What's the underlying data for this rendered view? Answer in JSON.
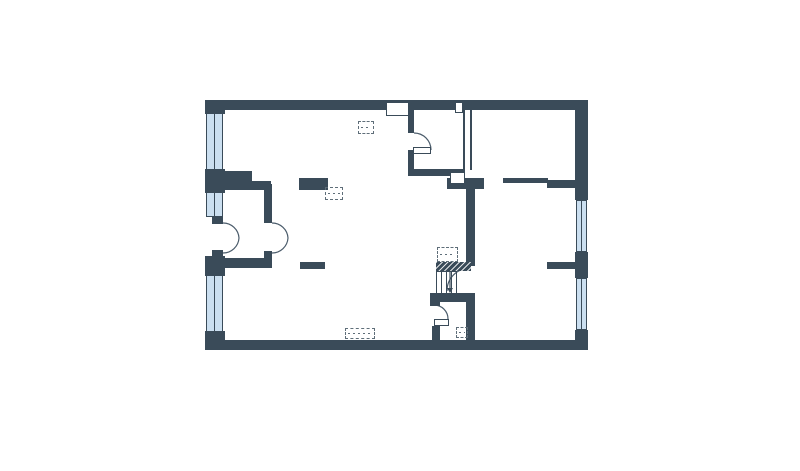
{
  "colors": {
    "wall": "#3a4b59",
    "window_fill": "#cbdff0",
    "symbol": "#5f6e79",
    "arc": "#4a5b6a",
    "background": "#ffffff"
  },
  "plan": {
    "canvas": {
      "width": 800,
      "height": 471
    },
    "walls": [
      {
        "name": "top-wall",
        "x": 205,
        "y": 100,
        "w": 383,
        "h": 10
      },
      {
        "name": "bottom-wall",
        "x": 205,
        "y": 340,
        "w": 383,
        "h": 10
      },
      {
        "name": "left-wall-top",
        "x": 205,
        "y": 100,
        "w": 20,
        "h": 14
      },
      {
        "name": "left-wall-mid-upper",
        "x": 205,
        "y": 169,
        "w": 20,
        "h": 24
      },
      {
        "name": "left-wall-mid-lower",
        "x": 205,
        "y": 256,
        "w": 20,
        "h": 20
      },
      {
        "name": "left-wall-bottom",
        "x": 205,
        "y": 331,
        "w": 20,
        "h": 19
      },
      {
        "name": "french-door-hinge-top",
        "x": 212,
        "y": 216,
        "w": 11,
        "h": 8
      },
      {
        "name": "french-door-hinge-bottom",
        "x": 212,
        "y": 250,
        "w": 11,
        "h": 8
      },
      {
        "name": "right-wall-top",
        "x": 575,
        "y": 100,
        "w": 13,
        "h": 100
      },
      {
        "name": "right-wall-mid",
        "x": 575,
        "y": 252,
        "w": 13,
        "h": 26
      },
      {
        "name": "right-wall-bottom",
        "x": 575,
        "y": 330,
        "w": 13,
        "h": 20
      },
      {
        "name": "vestibule-wall-upper-a",
        "x": 225,
        "y": 171,
        "w": 27,
        "h": 19
      },
      {
        "name": "vestibule-wall-upper-b",
        "x": 250,
        "y": 181,
        "w": 21,
        "h": 9
      },
      {
        "name": "vestibule-wall-right-upper",
        "x": 264,
        "y": 184,
        "w": 8,
        "h": 39
      },
      {
        "name": "vestibule-wall-lower",
        "x": 225,
        "y": 258,
        "w": 46,
        "h": 10
      },
      {
        "name": "vestibule-wall-right-lower",
        "x": 264,
        "y": 251,
        "w": 8,
        "h": 17
      },
      {
        "name": "stub-wall-upper",
        "x": 299,
        "y": 178,
        "w": 29,
        "h": 12
      },
      {
        "name": "stub-wall-lower",
        "x": 300,
        "y": 262,
        "w": 25,
        "h": 7
      },
      {
        "name": "closet-wall-left-upper",
        "x": 408,
        "y": 110,
        "w": 6,
        "h": 23
      },
      {
        "name": "closet-wall-left-lower",
        "x": 408,
        "y": 150,
        "w": 6,
        "h": 26
      },
      {
        "name": "closet-wall-bottom",
        "x": 408,
        "y": 169,
        "w": 57,
        "h": 7
      },
      {
        "name": "partition-thin-line-left",
        "x": 463,
        "y": 110,
        "w": 2,
        "h": 60
      },
      {
        "name": "partition-thin-line-right",
        "x": 470,
        "y": 110,
        "w": 2,
        "h": 60
      },
      {
        "name": "duct-block",
        "x": 447,
        "y": 178,
        "w": 37,
        "h": 11
      },
      {
        "name": "hall-wall-thin",
        "x": 503,
        "y": 178,
        "w": 45,
        "h": 5
      },
      {
        "name": "hall-wall-thick",
        "x": 547,
        "y": 180,
        "w": 28,
        "h": 8
      },
      {
        "name": "partition-mid",
        "x": 466,
        "y": 189,
        "w": 9,
        "h": 77
      },
      {
        "name": "partition-low",
        "x": 466,
        "y": 293,
        "w": 9,
        "h": 47
      },
      {
        "name": "bedroom-stub-wall",
        "x": 547,
        "y": 262,
        "w": 28,
        "h": 7
      },
      {
        "name": "stair-base-wall",
        "x": 430,
        "y": 293,
        "w": 41,
        "h": 9
      },
      {
        "name": "entry-corner-wall",
        "x": 430,
        "y": 293,
        "w": 10,
        "h": 13
      },
      {
        "name": "entry-wall-lower",
        "x": 432,
        "y": 326,
        "w": 8,
        "h": 14
      }
    ],
    "windows": [
      {
        "name": "window-left-1",
        "x": 206,
        "y": 113,
        "w": 17,
        "h": 57
      },
      {
        "name": "window-left-2",
        "x": 206,
        "y": 192,
        "w": 17,
        "h": 25
      },
      {
        "name": "window-left-3",
        "x": 206,
        "y": 275,
        "w": 17,
        "h": 57
      },
      {
        "name": "window-right-1",
        "x": 576,
        "y": 200,
        "w": 11,
        "h": 52
      },
      {
        "name": "window-right-2",
        "x": 576,
        "y": 278,
        "w": 11,
        "h": 52
      }
    ],
    "outlines": [
      {
        "name": "wall-niche",
        "x": 386,
        "y": 102,
        "w": 23,
        "h": 14
      },
      {
        "name": "wall-notch",
        "x": 455,
        "y": 102,
        "w": 8,
        "h": 11
      },
      {
        "name": "duct-step",
        "x": 450,
        "y": 172,
        "w": 15,
        "h": 12
      },
      {
        "name": "closet-door-leaf",
        "x": 413,
        "y": 147,
        "w": 18,
        "h": 7
      },
      {
        "name": "entry-door-leaf",
        "x": 434,
        "y": 319,
        "w": 15,
        "h": 7
      }
    ],
    "dashed_symbols": [
      {
        "name": "shaft-symbol-1",
        "x": 358,
        "y": 121,
        "w": 16,
        "h": 13
      },
      {
        "name": "shaft-symbol-2",
        "x": 325,
        "y": 187,
        "w": 18,
        "h": 13
      },
      {
        "name": "shaft-symbol-3",
        "x": 456,
        "y": 327,
        "w": 12,
        "h": 11
      },
      {
        "name": "radiator-symbol",
        "x": 345,
        "y": 328,
        "w": 30,
        "h": 11
      },
      {
        "name": "stair-upper-flight",
        "x": 437,
        "y": 247,
        "w": 21,
        "h": 15
      }
    ],
    "stairs": {
      "break_band": {
        "x": 436,
        "y": 262,
        "w": 35,
        "h": 9
      },
      "treads": {
        "x": 436,
        "y": 271,
        "w": 21,
        "h": 23
      },
      "arrow": {
        "x": 450,
        "y1": 272,
        "y2": 288
      }
    },
    "door_arcs": [
      {
        "name": "door-arc-french-left-top",
        "d": "M 223 223 A 16 16 0 0 1 239 238"
      },
      {
        "name": "door-arc-french-left-bottom",
        "d": "M 223 253 A 16 16 0 0 0 239 238"
      },
      {
        "name": "door-arc-french-right-top",
        "d": "M 272 223 A 16 16 0 0 1 288 238"
      },
      {
        "name": "door-arc-french-right-bottom",
        "d": "M 272 253 A 16 16 0 0 0 288 238"
      },
      {
        "name": "door-arc-closet",
        "d": "M 414 133 A 17 17 0 0 1 431 150"
      },
      {
        "name": "door-arc-bedroom",
        "d": "M 470 268 A 23 23 0 0 0 447 291"
      },
      {
        "name": "door-arc-entry",
        "d": "M 434 305 A 14 14 0 0 1 448 319"
      }
    ]
  }
}
